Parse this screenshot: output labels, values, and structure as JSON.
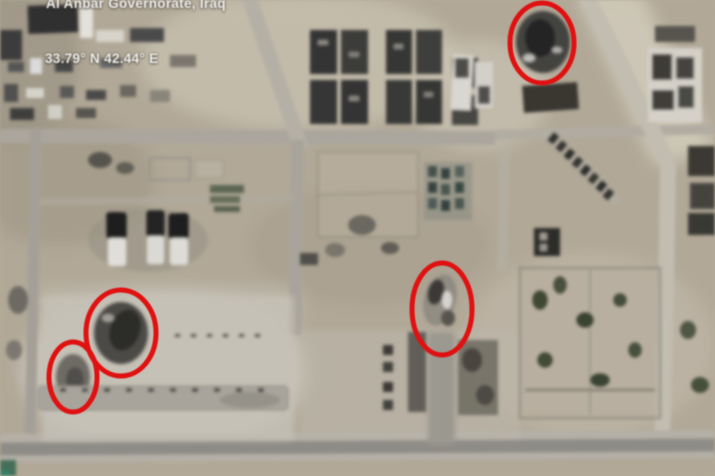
{
  "overlay": {
    "location_label": "Al Anbar Governorate, Iraq",
    "coordinates_label": "33.79° N 42.44° E"
  },
  "annotations": {
    "color": "#e01111",
    "stroke_width": 5,
    "circles": [
      {
        "name": "damage-site-northeast",
        "cx": 542,
        "cy": 43,
        "rx": 32,
        "ry": 40
      },
      {
        "name": "damage-site-center",
        "cx": 442,
        "cy": 309,
        "rx": 30,
        "ry": 46
      },
      {
        "name": "damage-site-west-large",
        "cx": 121,
        "cy": 333,
        "rx": 35,
        "ry": 43
      },
      {
        "name": "damage-site-west-small",
        "cx": 73,
        "cy": 377,
        "rx": 24,
        "ry": 35
      }
    ]
  }
}
